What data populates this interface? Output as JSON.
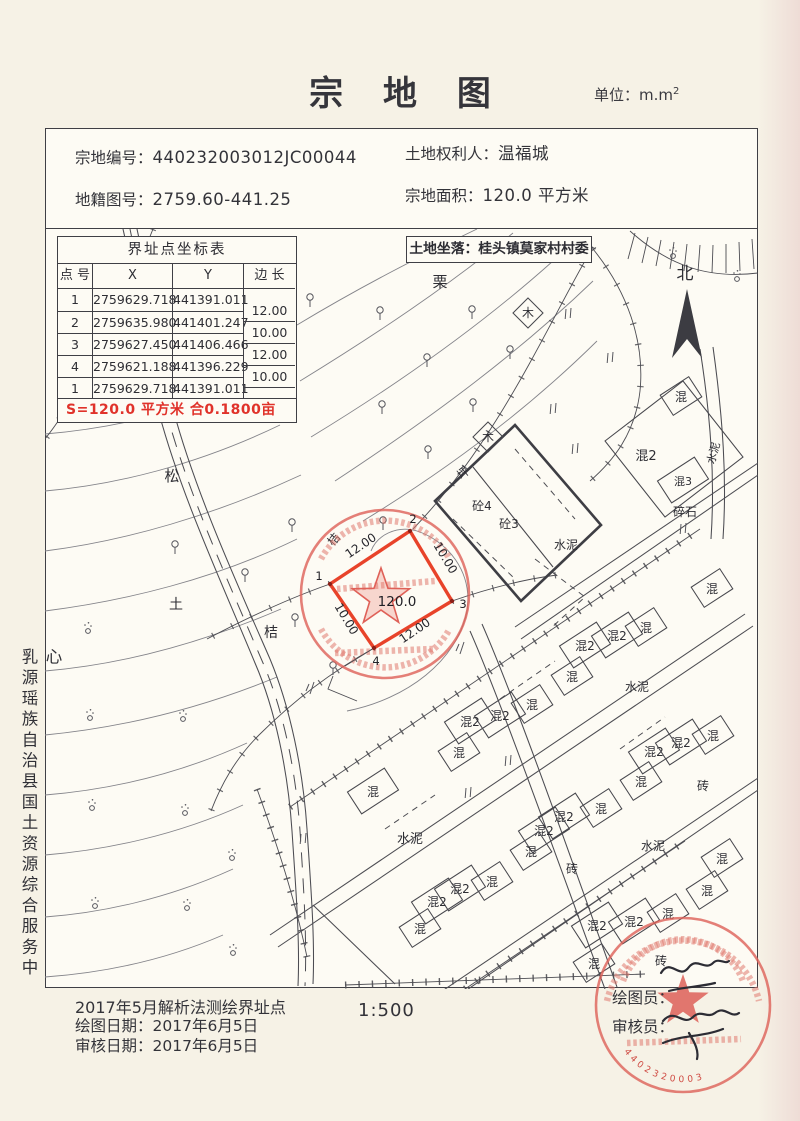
{
  "page": {
    "title": "宗 地 图",
    "unit": "单位：m.m",
    "unit_exp": "2"
  },
  "header": {
    "parcel_no_label": "宗地编号：",
    "parcel_no": "440232003012JC00044",
    "cadastral_no_label": "地籍图号：",
    "cadastral_no": "2759.60-441.25",
    "owner_label": "土地权利人：",
    "owner": "温福城",
    "area_label": "宗地面积：",
    "area_value": "120.0 平方米"
  },
  "coord_table": {
    "title": "界址点坐标表",
    "columns": [
      "点 号",
      "X",
      "Y",
      "边 长"
    ],
    "rows": [
      {
        "pt": "1",
        "x": "2759629.718",
        "y": "441391.011"
      },
      {
        "pt": "2",
        "x": "2759635.980",
        "y": "441401.247"
      },
      {
        "pt": "3",
        "x": "2759627.450",
        "y": "441406.466"
      },
      {
        "pt": "4",
        "x": "2759621.188",
        "y": "441396.229"
      },
      {
        "pt": "1",
        "x": "2759629.718",
        "y": "441391.011"
      }
    ],
    "edges": [
      "12.00",
      "10.00",
      "12.00",
      "10.00"
    ],
    "area_note": "S=120.0 平方米 合0.1800亩"
  },
  "location": "土地坐落：桂头镇莫家村村委",
  "compass": "北",
  "org": "乳源瑶族自治县国土资源综合服务中心",
  "parcel": {
    "area": "120.0",
    "corners": [
      {
        "n": "1",
        "x": 285,
        "y": 355
      },
      {
        "n": "2",
        "x": 365,
        "y": 302
      },
      {
        "n": "3",
        "x": 407,
        "y": 372
      },
      {
        "n": "4",
        "x": 329,
        "y": 419
      }
    ],
    "edge_labels": [
      {
        "t": "12.00",
        "x": 318,
        "y": 320,
        "r": -34
      },
      {
        "t": "10.00",
        "x": 397,
        "y": 331,
        "r": 59
      },
      {
        "t": "12.00",
        "x": 372,
        "y": 405,
        "r": -34
      },
      {
        "t": "10.00",
        "x": 298,
        "y": 392,
        "r": 59
      }
    ]
  },
  "map_labels": [
    {
      "t": "栗",
      "x": 395,
      "y": 58,
      "s": 15
    },
    {
      "t": "木",
      "x": 483,
      "y": 88,
      "k": "d",
      "s": 12
    },
    {
      "t": "松",
      "x": 127,
      "y": 252,
      "s": 15
    },
    {
      "t": "木",
      "x": 443,
      "y": 212,
      "k": "d",
      "s": 12
    },
    {
      "t": "坪",
      "x": 421,
      "y": 247,
      "s": 12,
      "r": -40
    },
    {
      "t": "砼4",
      "x": 437,
      "y": 281,
      "s": 12
    },
    {
      "t": "砼3",
      "x": 464,
      "y": 299,
      "s": 12
    },
    {
      "t": "水泥",
      "x": 521,
      "y": 320,
      "s": 12
    },
    {
      "t": "混",
      "x": 636,
      "y": 172,
      "k": "b"
    },
    {
      "t": "混2",
      "x": 601,
      "y": 231,
      "s": 13
    },
    {
      "t": "混3",
      "x": 638,
      "y": 256,
      "k": "b2",
      "s": 11
    },
    {
      "t": "碎石",
      "x": 640,
      "y": 287,
      "s": 12
    },
    {
      "t": "水泥",
      "x": 672,
      "y": 225,
      "s": 11,
      "r": -75
    },
    {
      "t": "桔",
      "x": 292,
      "y": 313,
      "s": 12,
      "r": -50
    },
    {
      "t": "土",
      "x": 131,
      "y": 380,
      "s": 14
    },
    {
      "t": "桔",
      "x": 226,
      "y": 408,
      "s": 14
    },
    {
      "t": "混",
      "x": 667,
      "y": 364,
      "k": "b"
    },
    {
      "t": "混2",
      "x": 540,
      "y": 421,
      "k": "b2"
    },
    {
      "t": "混2",
      "x": 572,
      "y": 411,
      "k": "b2"
    },
    {
      "t": "混",
      "x": 601,
      "y": 403,
      "k": "b"
    },
    {
      "t": "混",
      "x": 527,
      "y": 452,
      "k": "b"
    },
    {
      "t": "水泥",
      "x": 592,
      "y": 462,
      "s": 12
    },
    {
      "t": "混",
      "x": 487,
      "y": 480,
      "k": "b"
    },
    {
      "t": "混2",
      "x": 455,
      "y": 491,
      "k": "b2"
    },
    {
      "t": "混2",
      "x": 425,
      "y": 497,
      "k": "b2"
    },
    {
      "t": "混",
      "x": 414,
      "y": 528,
      "k": "b"
    },
    {
      "t": "混",
      "x": 328,
      "y": 567,
      "k": "b2"
    },
    {
      "t": "混2",
      "x": 609,
      "y": 527,
      "k": "b2"
    },
    {
      "t": "混2",
      "x": 636,
      "y": 518,
      "k": "b2"
    },
    {
      "t": "混",
      "x": 668,
      "y": 511,
      "k": "b"
    },
    {
      "t": "混",
      "x": 596,
      "y": 557,
      "k": "b"
    },
    {
      "t": "砖",
      "x": 658,
      "y": 561,
      "s": 12
    },
    {
      "t": "混",
      "x": 556,
      "y": 584,
      "k": "b"
    },
    {
      "t": "混2",
      "x": 519,
      "y": 592,
      "k": "b2"
    },
    {
      "t": "混2",
      "x": 499,
      "y": 606,
      "k": "b2"
    },
    {
      "t": "水泥",
      "x": 365,
      "y": 614,
      "s": 13
    },
    {
      "t": "混",
      "x": 486,
      "y": 627,
      "k": "b"
    },
    {
      "t": "水泥",
      "x": 608,
      "y": 621,
      "s": 12
    },
    {
      "t": "砖",
      "x": 527,
      "y": 644,
      "s": 12
    },
    {
      "t": "混",
      "x": 447,
      "y": 657,
      "k": "b"
    },
    {
      "t": "混2",
      "x": 415,
      "y": 664,
      "k": "b2"
    },
    {
      "t": "混2",
      "x": 392,
      "y": 677,
      "k": "b2"
    },
    {
      "t": "混",
      "x": 375,
      "y": 704,
      "k": "b"
    },
    {
      "t": "混",
      "x": 677,
      "y": 634,
      "k": "b"
    },
    {
      "t": "混",
      "x": 662,
      "y": 666,
      "k": "b"
    },
    {
      "t": "混",
      "x": 623,
      "y": 689,
      "k": "b"
    },
    {
      "t": "混2",
      "x": 589,
      "y": 697,
      "k": "b2"
    },
    {
      "t": "混2",
      "x": 552,
      "y": 701,
      "k": "b2"
    },
    {
      "t": "混",
      "x": 549,
      "y": 739,
      "k": "b"
    },
    {
      "t": "砖",
      "x": 616,
      "y": 736,
      "s": 12
    }
  ],
  "symbols": {
    "trees": [
      [
        265,
        72
      ],
      [
        335,
        85
      ],
      [
        427,
        84
      ],
      [
        465,
        124
      ],
      [
        382,
        132
      ],
      [
        337,
        179
      ],
      [
        428,
        177
      ],
      [
        383,
        224
      ],
      [
        247,
        297
      ],
      [
        338,
        295
      ],
      [
        130,
        319
      ],
      [
        200,
        347
      ],
      [
        250,
        392
      ],
      [
        288,
        440
      ],
      [
        160,
        40
      ],
      [
        205,
        28
      ]
    ],
    "shrubs": [
      [
        43,
        402
      ],
      [
        45,
        489
      ],
      [
        47,
        579
      ],
      [
        50,
        677
      ],
      [
        138,
        490
      ],
      [
        140,
        584
      ],
      [
        187,
        629
      ],
      [
        142,
        679
      ],
      [
        188,
        724
      ],
      [
        628,
        27
      ],
      [
        692,
        50
      ]
    ],
    "grass": [
      [
        523,
        85
      ],
      [
        508,
        180
      ],
      [
        530,
        220
      ],
      [
        565,
        129
      ],
      [
        463,
        532
      ],
      [
        423,
        564
      ],
      [
        258,
        610
      ],
      [
        638,
        300
      ]
    ],
    "tufts": [
      [
        265,
        459
      ],
      [
        415,
        419
      ]
    ]
  },
  "stamp": {
    "digits": "4402320003"
  },
  "footer": {
    "survey_note": "2017年5月解析法测绘界址点",
    "draw_date_label": "绘图日期：",
    "draw_date": "2017年6月5日",
    "review_date_label": "审核日期：",
    "review_date": "2017年6月5日",
    "scale": "1:500",
    "drafter_label": "绘图员：",
    "reviewer_label": "审核员："
  },
  "colors": {
    "parcel_red": "#e8432a",
    "stamp_red": "#dd6058",
    "note_red": "#e0322a",
    "ink": "#3f3f45",
    "paper": "#f6f2e6"
  }
}
